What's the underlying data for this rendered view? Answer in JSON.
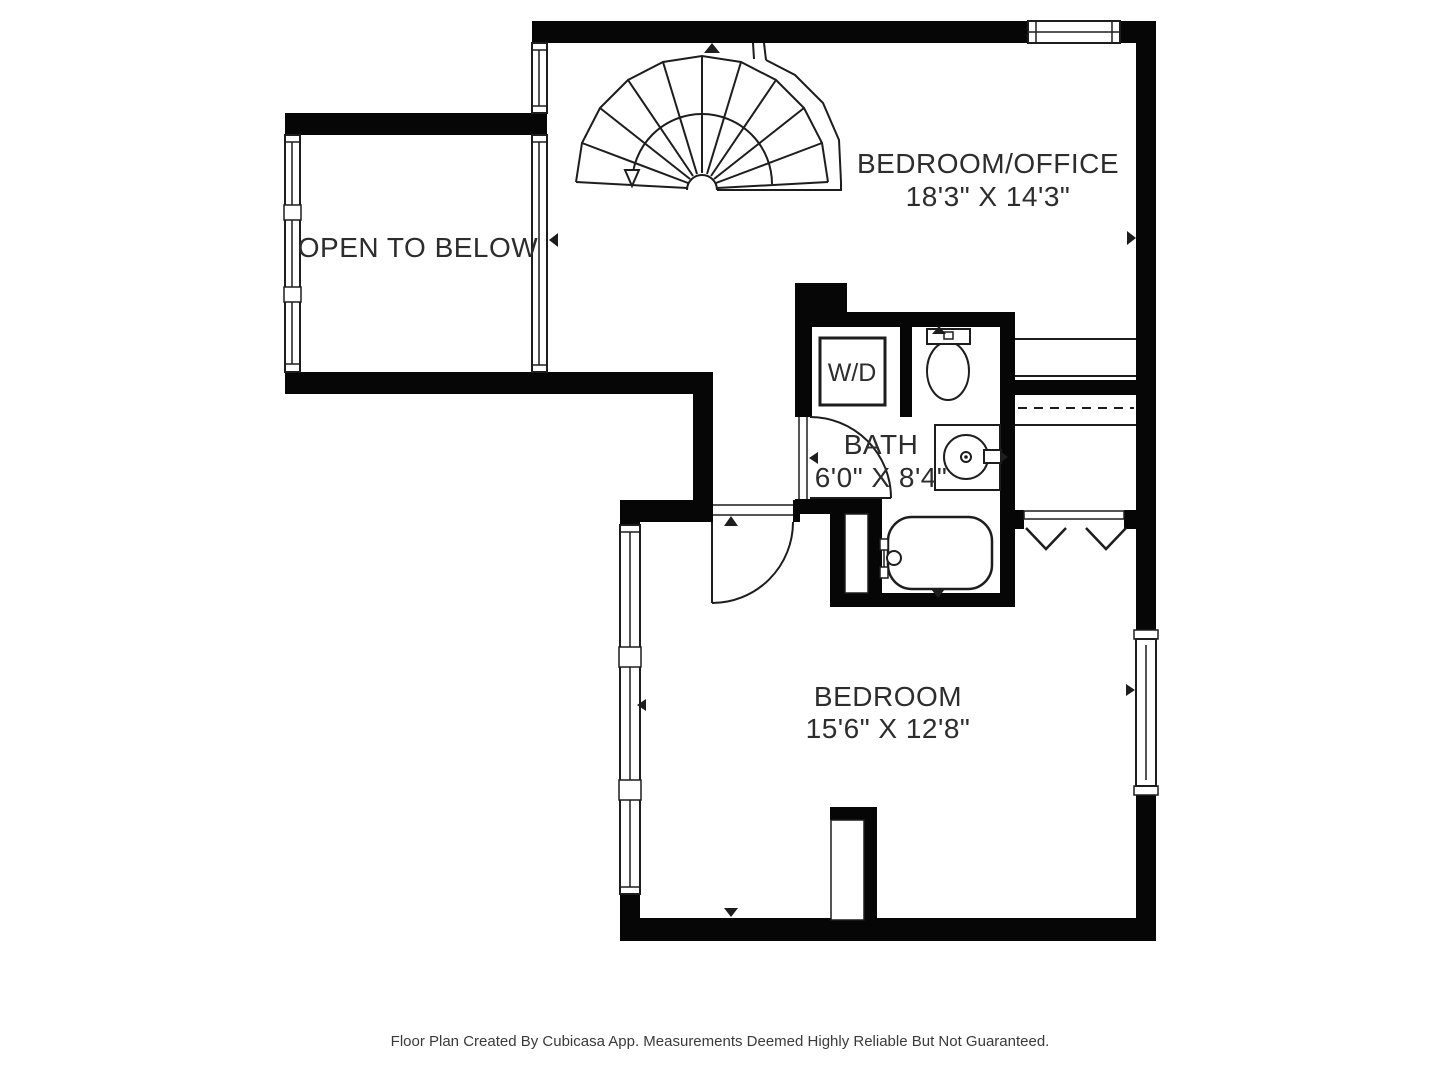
{
  "rooms": [
    {
      "name": "BEDROOM/OFFICE",
      "dimensions": "18'3\" X 14'3\""
    },
    {
      "name": "OPEN TO BELOW",
      "dimensions": ""
    },
    {
      "name": "BATH",
      "dimensions": "6'0\" X 8'4\""
    },
    {
      "name": "BEDROOM",
      "dimensions": "15'6\" X 12'8\""
    }
  ],
  "fixtures": {
    "washer_dryer_label": "W/D"
  },
  "footer": {
    "text": "Floor Plan Created By Cubicasa App. Measurements Deemed Highly Reliable But Not Guaranteed."
  },
  "colors": {
    "background": "#ffffff",
    "wall": "#060606",
    "line": "#1d1d1d",
    "text": "#2d2d2d",
    "footer_text": "#3a3a3a"
  }
}
